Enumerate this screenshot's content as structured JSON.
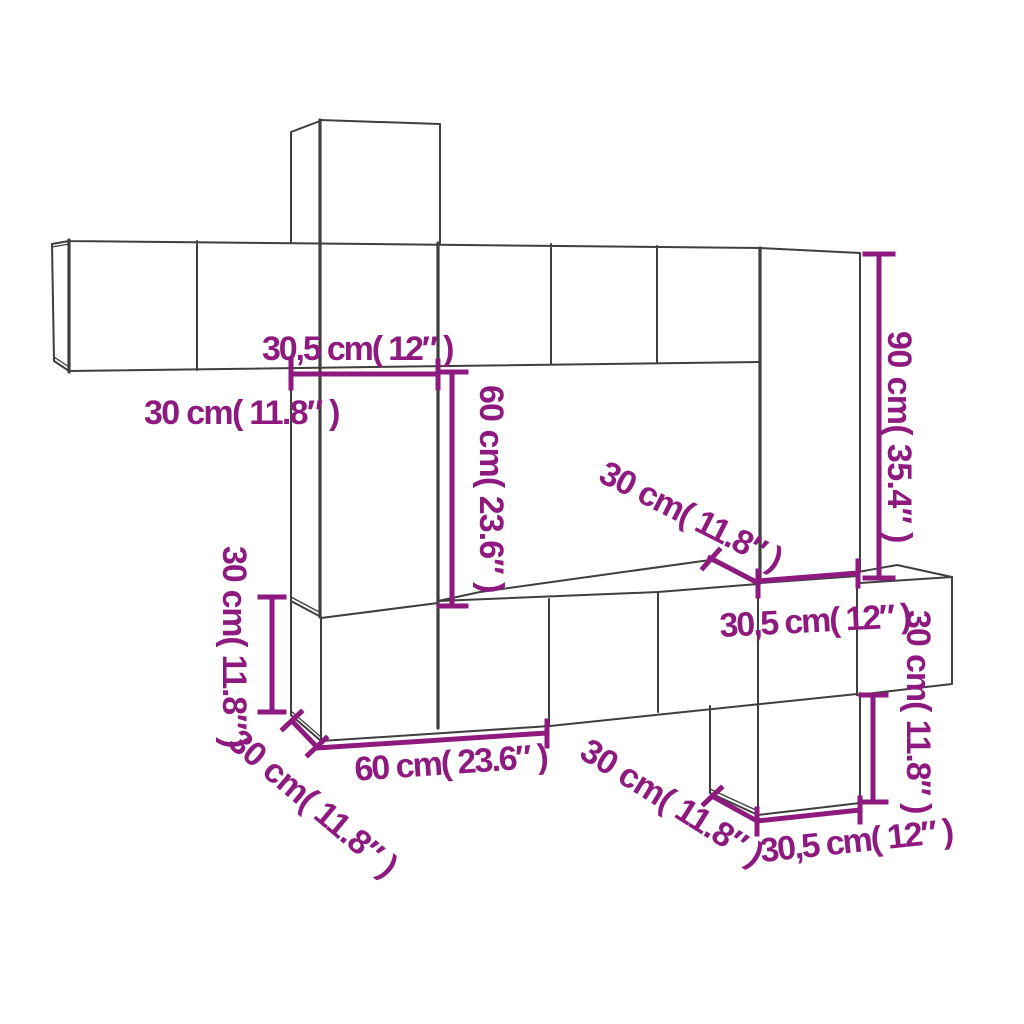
{
  "diagram": {
    "description": "Wall-mounted TV cabinet set dimension drawing",
    "background_color": "#ffffff",
    "line_color": "#3f3f3f",
    "accent_color": "#8e1a80",
    "labels": {
      "top_width": "30,5 cm( 12″ )",
      "upper_left_depth": "30 cm( 11.8″ )",
      "center_height": "60 cm( 23.6″ )",
      "middle_depth": "30 cm( 11.8″ )",
      "right_height": "90 cm( 35.4″ )",
      "left_height": "30 cm( 11.8″ )",
      "bottom_left_depth": "30 cm( 11.8″ )",
      "bottom_width": "60 cm( 23.6″ )",
      "right_middle_width": "30,5 cm( 12″ )",
      "far_right_height": "30 cm( 11.8″ )",
      "bottom_right_depth": "30 cm( 11.8″ )",
      "bottom_right_width": "30,5 cm( 12″ )"
    }
  }
}
